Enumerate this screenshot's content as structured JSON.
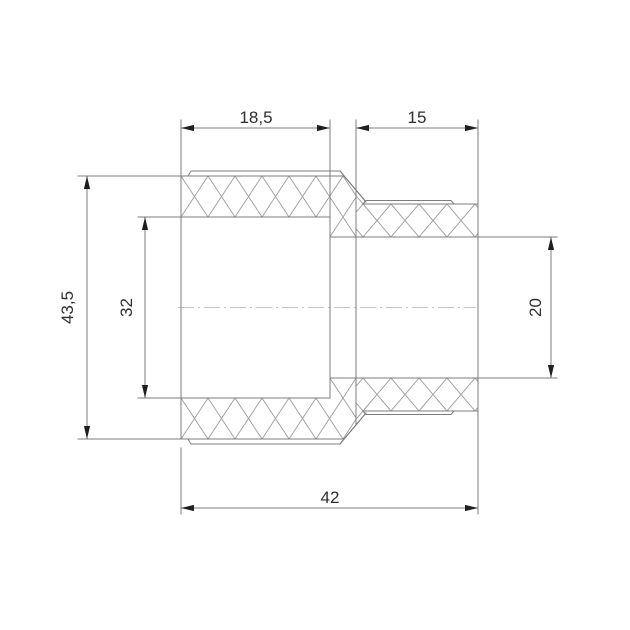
{
  "drawing": {
    "view": "reducing-coupling-section-view",
    "dimensions": {
      "left_socket_depth": "18,5",
      "right_socket_depth": "15",
      "body_outer_diameter": "43,5",
      "left_bore_diameter": "32",
      "right_bore_diameter": "20",
      "overall_length": "42"
    },
    "colors": {
      "outline": "#7c7c7c",
      "hatch": "#9e9e9e",
      "centerline": "#c4c4c4",
      "arrow": "#1f1f1f",
      "label_text": "#2e2e2e",
      "background": "#ffffff"
    }
  }
}
